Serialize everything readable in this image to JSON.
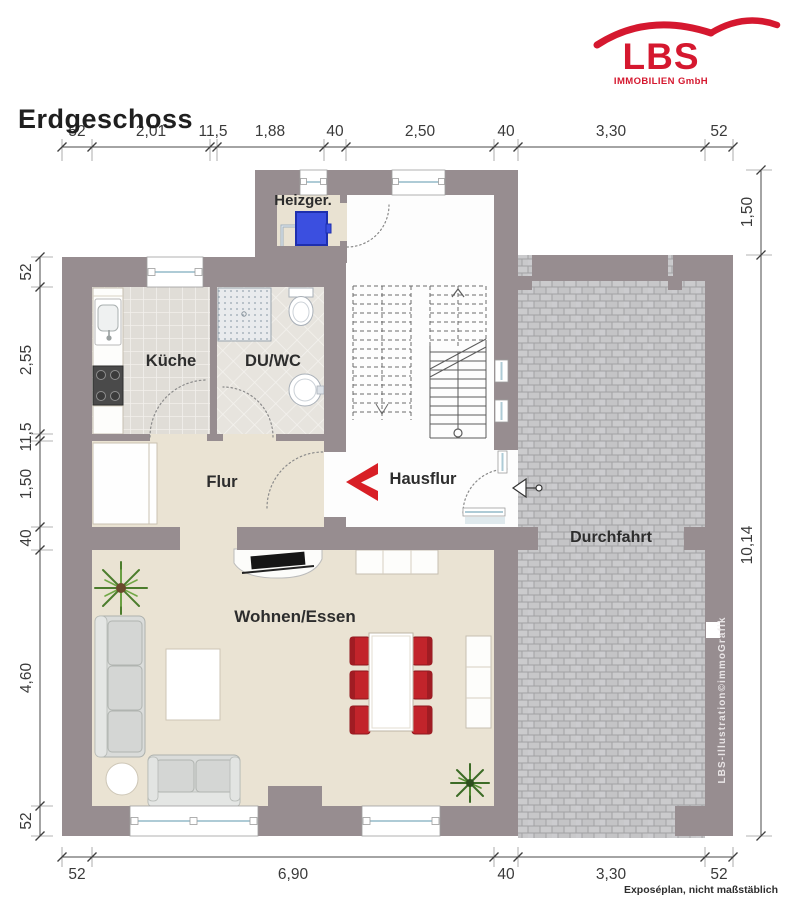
{
  "header": {
    "title": "Erdgeschoss"
  },
  "logo": {
    "name": "LBS",
    "subtitle": "IMMOBILIEN GmbH"
  },
  "rooms": {
    "heizger": "Heizger.",
    "kueche": "Küche",
    "duwc": "DU/WC",
    "flur": "Flur",
    "hausflur": "Hausflur",
    "durchfahrt": "Durchfahrt",
    "wohnen": "Wohnen/Essen"
  },
  "dimensions": {
    "top": [
      "52",
      "2,01",
      "11,5",
      "1,88",
      "40",
      "2,50",
      "40",
      "3,30",
      "52"
    ],
    "left": [
      "52",
      "2,55",
      "11,5",
      "1,50",
      "40",
      "4,60",
      "52"
    ],
    "right": [
      "1,50",
      "10,14"
    ],
    "bottom": [
      "52",
      "6,90",
      "40",
      "3,30",
      "52"
    ]
  },
  "footer": {
    "note": "Exposéplan, nicht maßstäblich"
  },
  "watermark": "LBS-Illustration©immoGrafik",
  "colors": {
    "brand_red": "#d5182f",
    "wall": "#978d90",
    "arrow_red": "#d81f26",
    "boiler_blue": "#3b4fe0"
  }
}
